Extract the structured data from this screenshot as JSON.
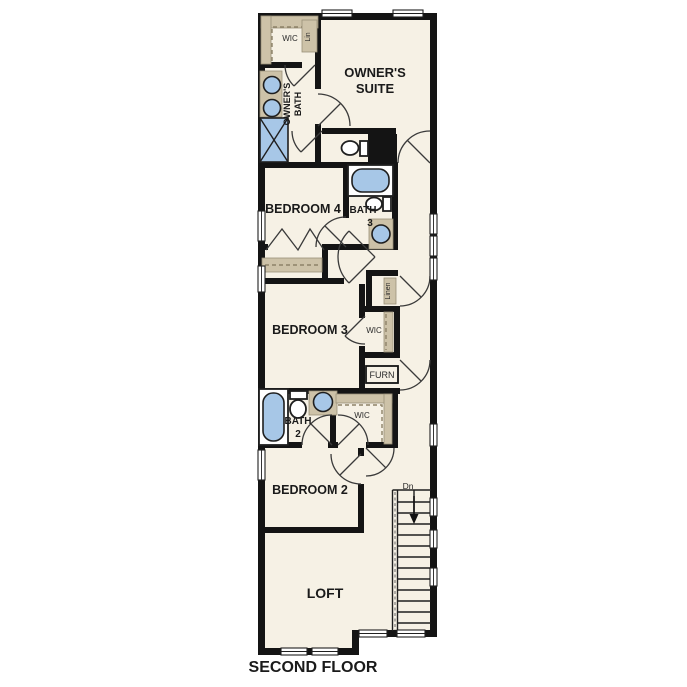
{
  "document": {
    "type": "floor-plan",
    "caption": "SECOND FLOOR"
  },
  "palette": {
    "background": "#ffffff",
    "floor": "#f6f1e5",
    "wall": "#141414",
    "cabinet_tan": "#cdc2a8",
    "fixture_blue": "#a7c7e7",
    "text": "#1a1a1a"
  },
  "labels": {
    "owners_suite_1": "OWNER'S",
    "owners_suite_2": "SUITE",
    "owners_bath_1": "OWNER'S",
    "owners_bath_2": "BATH",
    "wic_owner": "WIC",
    "lin": "Lin",
    "bedroom4": "BEDROOM 4",
    "bath3_1": "BATH",
    "bath3_2": "3",
    "bedroom3": "BEDROOM 3",
    "linen": "Linen",
    "wic_bed3": "WIC",
    "furn": "FURN",
    "bath2_1": "BATH",
    "bath2_2": "2",
    "wic_bed2": "WIC",
    "bedroom2": "BEDROOM 2",
    "loft": "LOFT",
    "stairs_dn": "Dn",
    "caption": "SECOND FLOOR"
  }
}
